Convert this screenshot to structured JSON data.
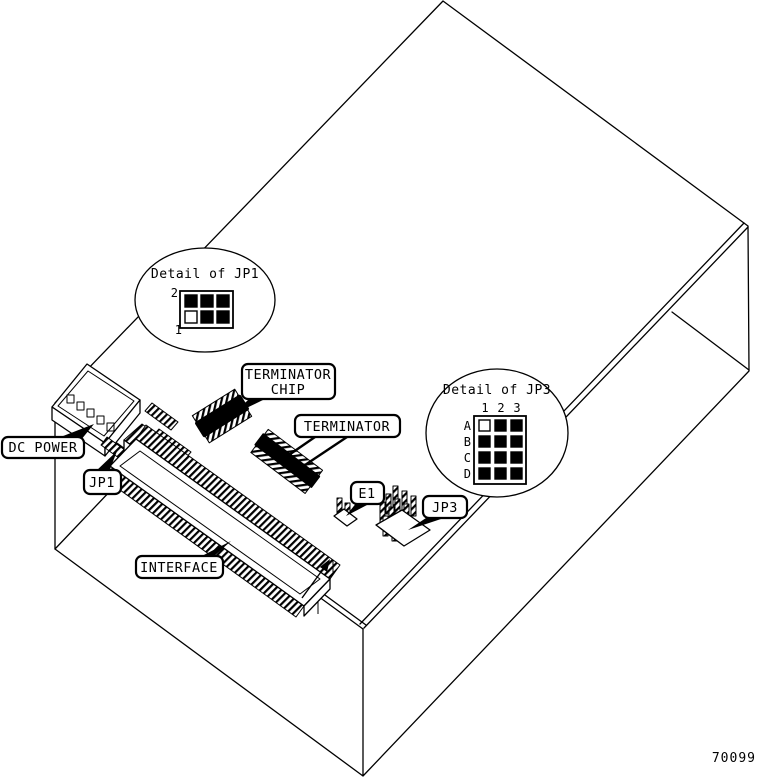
{
  "figure": {
    "part_number": "70099",
    "background_color": "#ffffff",
    "ink_color": "#000000"
  },
  "labels": {
    "dc_power": "DC POWER",
    "jp1": "JP1",
    "terminator_chip": {
      "line1": "TERMINATOR",
      "line2": "CHIP"
    },
    "terminator": "TERMINATOR",
    "interface": "INTERFACE",
    "e1": "E1",
    "jp3": "JP3"
  },
  "details": {
    "jp1": {
      "title": "Detail of JP1",
      "pin_row_top": "2",
      "pin_row_bottom": "1",
      "cell_fills": [
        "#000000",
        "#000000",
        "#000000",
        "#ffffff",
        "#000000",
        "#000000"
      ]
    },
    "jp3": {
      "title": "Detail of JP3",
      "col_labels": [
        "1",
        "2",
        "3"
      ],
      "row_labels": [
        "A",
        "B",
        "C",
        "D"
      ],
      "cell_fills": [
        "#ffffff",
        "#000000",
        "#000000",
        "#000000",
        "#000000",
        "#000000",
        "#000000",
        "#000000",
        "#000000",
        "#000000",
        "#000000",
        "#000000"
      ]
    }
  }
}
